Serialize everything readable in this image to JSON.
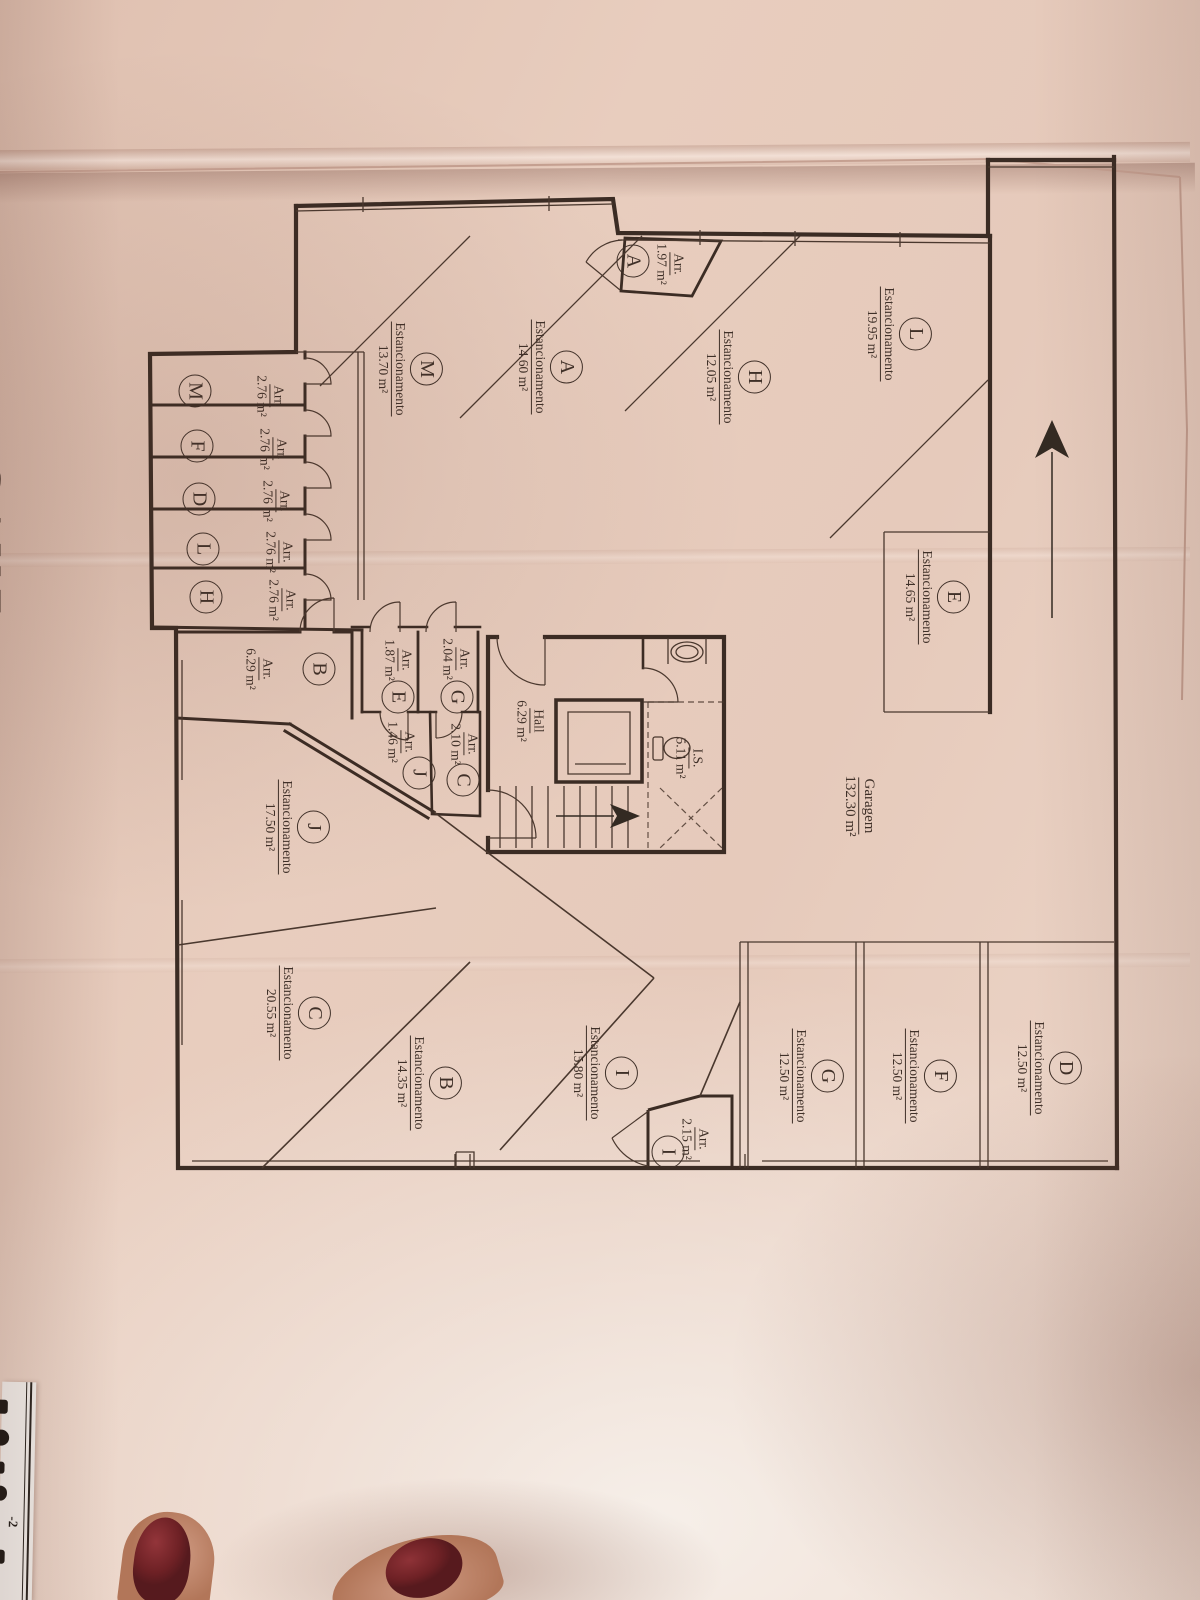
{
  "photo": {
    "floor_title": "CAVE",
    "corner_fragment": "-2",
    "colors": {
      "paper": "#e6cabb",
      "ink": "#3f3028",
      "wood": "#8f5f33",
      "nail_polish": "#6e2125"
    }
  },
  "plan": {
    "garage": {
      "label": "Garagem",
      "area": "132.30 m²"
    },
    "hall": {
      "label": "Hall",
      "area": "6.29 m²"
    },
    "wc": {
      "label": "I.S.",
      "area": "5.11 m²"
    },
    "parking": [
      {
        "id": "L",
        "label": "Estancionamento",
        "area": "19.95 m²"
      },
      {
        "id": "H",
        "label": "Estancionamento",
        "area": "12.05 m²"
      },
      {
        "id": "A",
        "label": "Estancionamento",
        "area": "14.60 m²"
      },
      {
        "id": "M",
        "label": "Estancionamento",
        "area": "13.70 m²"
      },
      {
        "id": "E",
        "label": "Estancionamento",
        "area": "14.65 m²"
      },
      {
        "id": "J",
        "label": "Estancionamento",
        "area": "17.50 m²"
      },
      {
        "id": "C",
        "label": "Estancionamento",
        "area": "20.55 m²"
      },
      {
        "id": "B",
        "label": "Estancionamento",
        "area": "14.35 m²"
      },
      {
        "id": "I",
        "label": "Estancionamento",
        "area": "15.80 m²"
      },
      {
        "id": "G",
        "label": "Estancionamento",
        "area": "12.50 m²"
      },
      {
        "id": "F",
        "label": "Estancionamento",
        "area": "12.50 m²"
      },
      {
        "id": "D",
        "label": "Estancionamento",
        "area": "12.50 m²"
      }
    ],
    "storage": [
      {
        "id": "A",
        "label": "Arr.",
        "area": "1.97 m²"
      },
      {
        "id": "M",
        "label": "Arr.",
        "area": "2.76 m²"
      },
      {
        "id": "F",
        "label": "Arr.",
        "area": "2.76 m²"
      },
      {
        "id": "D",
        "label": "Arr.",
        "area": "2.76 m²"
      },
      {
        "id": "L",
        "label": "Arr.",
        "area": "2.76 m²"
      },
      {
        "id": "H",
        "label": "Arr.",
        "area": "2.76 m²"
      },
      {
        "id": "B",
        "label": "Arr.",
        "area": "6.29 m²"
      },
      {
        "id": "E",
        "label": "Arr.",
        "area": "1.87 m²"
      },
      {
        "id": "G",
        "label": "Arr.",
        "area": "2.04 m²"
      },
      {
        "id": "J",
        "label": "Arr.",
        "area": "1.46 m²"
      },
      {
        "id": "C",
        "label": "Arr.",
        "area": "2.10 m²"
      },
      {
        "id": "I",
        "label": "Arr.",
        "area": "2.15 m²"
      }
    ]
  }
}
